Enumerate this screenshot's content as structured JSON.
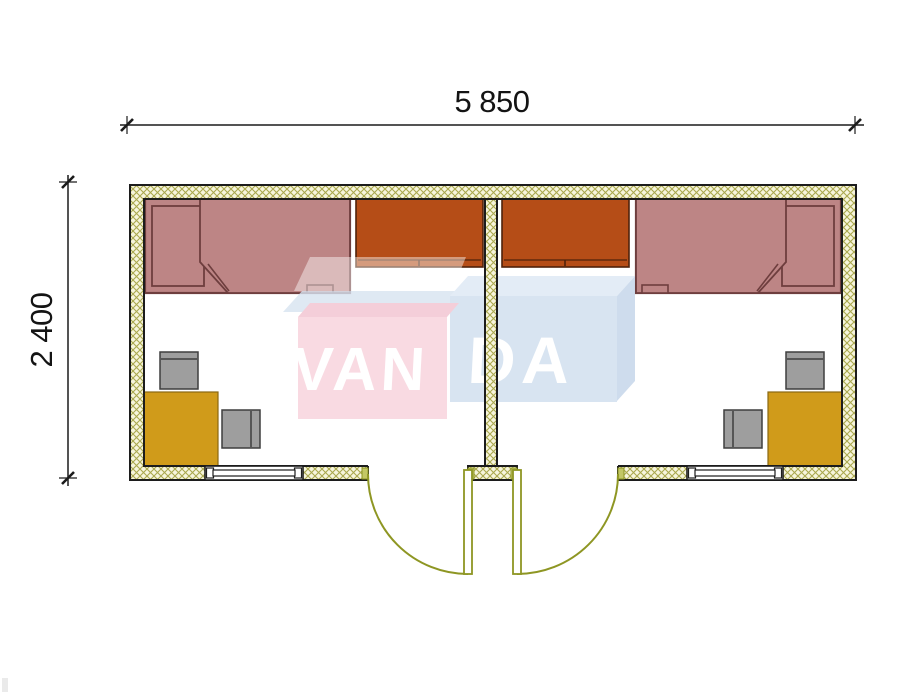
{
  "drawing": {
    "kind": "two-room cabin floor plan",
    "width_dimension": "5 850",
    "height_dimension": "2 400"
  },
  "watermark": {
    "text": "VANDA",
    "part1": "VAN",
    "part2": "DA"
  },
  "colors": {
    "bed": "#bd8585",
    "bed_outline": "#6e3e3e",
    "wardrobe": "#b54d17",
    "desk": "#d09b1a",
    "chair": "#9e9e9e",
    "wall_fill": "#f7f5dc",
    "wall_hatch": "#aaa84e",
    "door": "#8e9623",
    "watermark_pink": "#f8d2dc",
    "watermark_pink_top": "#f2c3d0",
    "watermark_blue": "#cfdeee",
    "watermark_blue_top": "#dde8f4",
    "dimension_text": "#141414"
  },
  "rooms": [
    {
      "name": "left room",
      "furniture": [
        "single bed",
        "wardrobe",
        "corner desk",
        "chair",
        "chair"
      ],
      "door": "outswing door",
      "window": "window"
    },
    {
      "name": "right room",
      "furniture": [
        "single bed",
        "wardrobe",
        "corner desk",
        "chair",
        "chair"
      ],
      "door": "outswing door",
      "window": "window"
    }
  ]
}
